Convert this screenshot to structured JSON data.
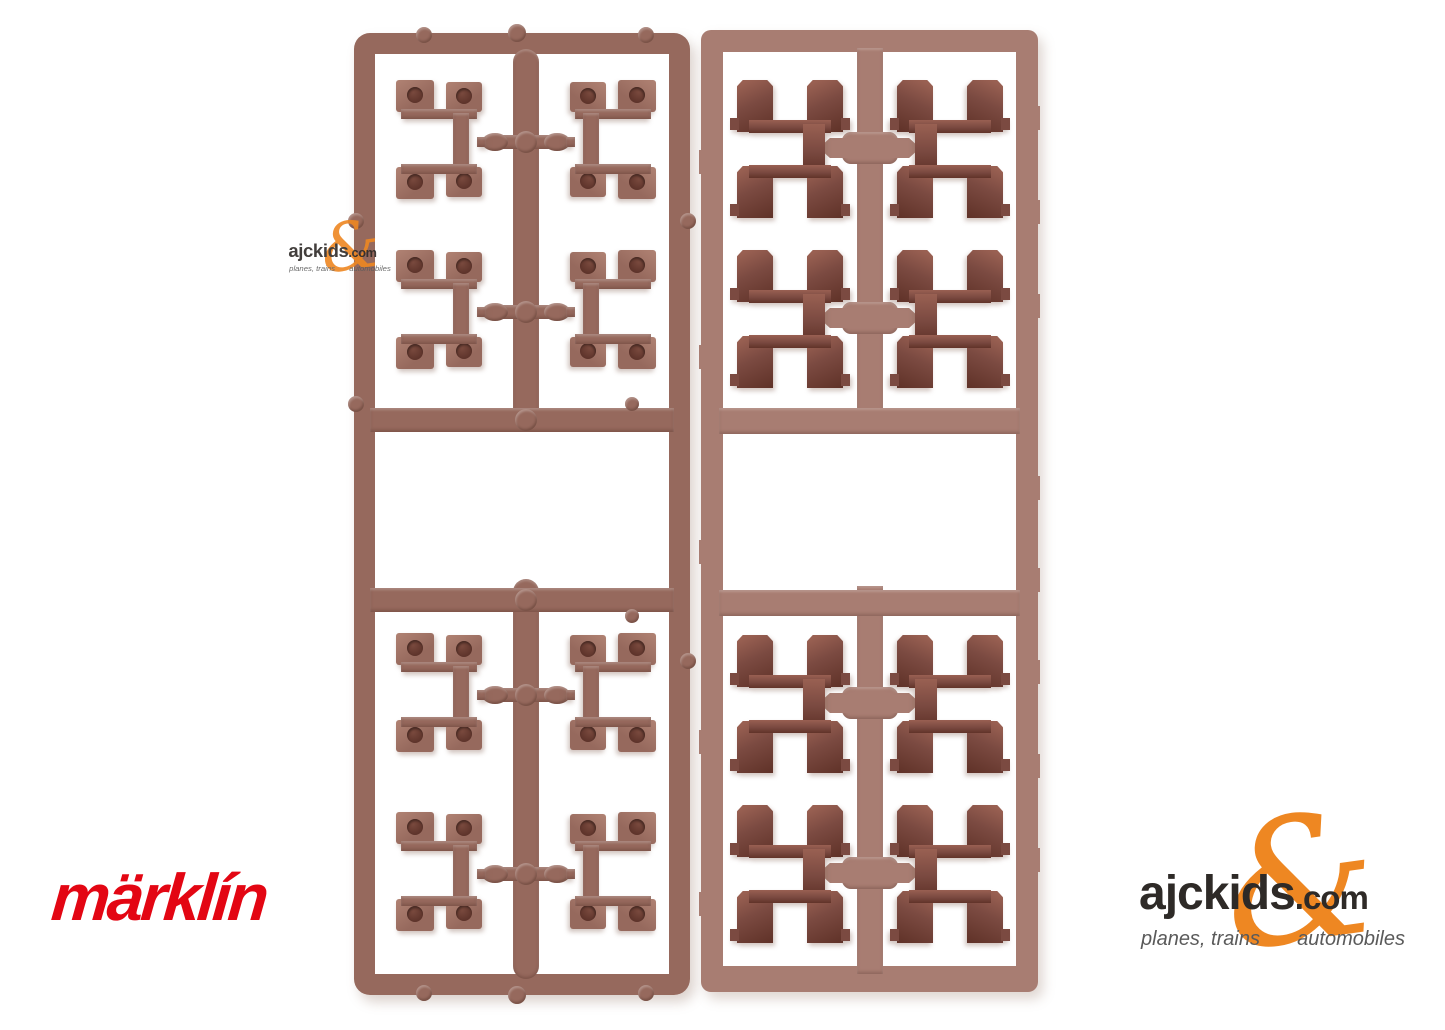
{
  "background_color": "#ffffff",
  "brand_logo": {
    "text": "märklín",
    "color": "#e30613"
  },
  "retailer_logo": {
    "name": "ajckids",
    "domain_suffix": ".com",
    "ampersand": "&",
    "tagline_left": "planes, trains",
    "tagline_right": "automobiles",
    "text_color": "#2e2a27",
    "accent_color": "#ee8722",
    "tagline_color": "#5a5a5a"
  },
  "watermark": {
    "name": "ajckids",
    "domain_suffix": ".com",
    "ampersand": "&",
    "tagline_left": "planes, trains",
    "tagline_right": "automobiles"
  },
  "sprues": {
    "left": {
      "parts_count": 8,
      "frame_color": "#96695d",
      "highlight_color": "#b08273",
      "hole_color": "#5e342b"
    },
    "right": {
      "parts_count": 8,
      "frame_color": "#a87d72",
      "part_color": "#7b4a41",
      "part_face_color": "#996052",
      "part_shadow_color": "#613329"
    }
  }
}
